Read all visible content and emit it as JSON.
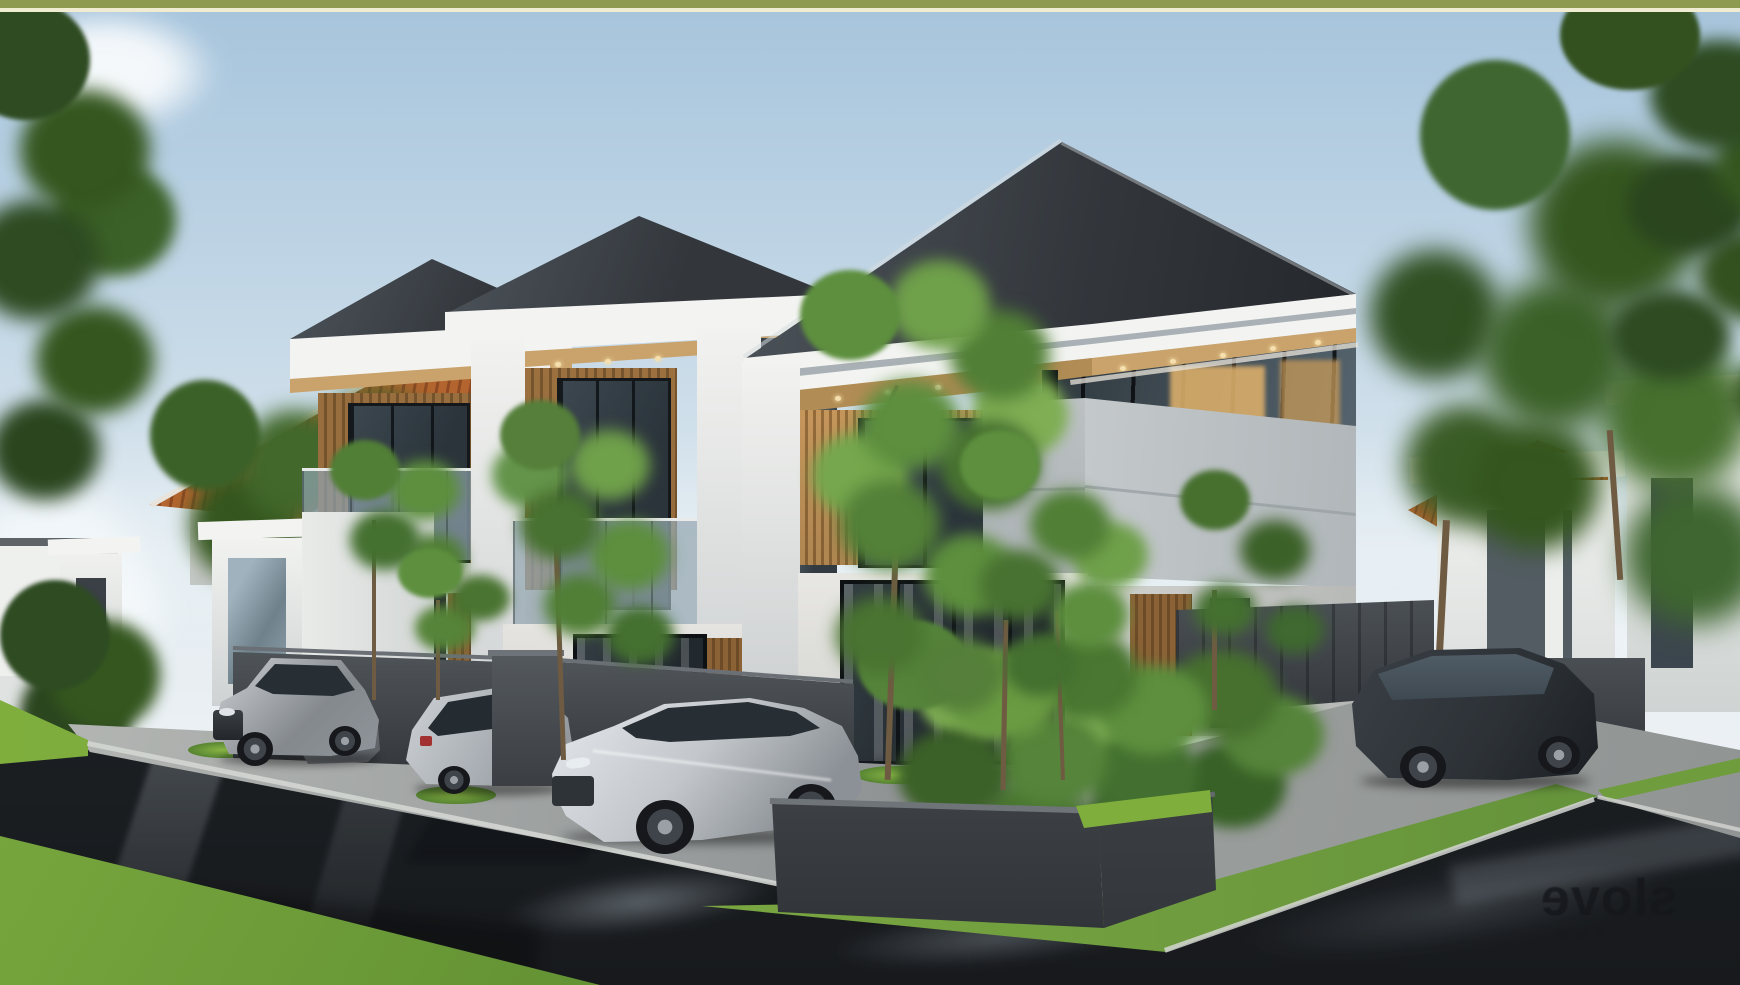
{
  "meta": {
    "kind": "architectural-exterior-render",
    "width_px": 1740,
    "height_px": 985,
    "alt": "3D exterior rendering of a row of modern two-storey minimalist townhouses on a wet street corner, dark hip roofs with white fascias, wood-slat upper walls, concrete balcony parapets, silver cars parked in the driveways, a dark SUV at the right, tropical planter beds, and a mirrored studio watermark on the road"
  },
  "watermark": {
    "text_mirrored": "slove",
    "note": "rendered horizontally mirrored so it reads like the stamped logo in the photo",
    "subtext": "w w w",
    "color": "#15171b"
  },
  "scene": {
    "townhouses_visible": 3,
    "background_buildings": [
      "terracotta tiled-roof house on the left",
      "single-storey white house on the right"
    ],
    "parked_cars": [
      {
        "type": "suv",
        "color": "silver"
      },
      {
        "type": "sedan",
        "color": "gray"
      },
      {
        "type": "hatchback",
        "color": "silver"
      },
      {
        "type": "sedan",
        "color": "silver"
      },
      {
        "type": "suv",
        "color": "dark-gray"
      }
    ],
    "weather": "clear pale-blue sky, road wet with puddle reflections"
  },
  "palette": {
    "frame_olive": "#8e9a4f",
    "frame_cream": "#efecd2",
    "sky_top": "#a6c4dc",
    "sky_mid": "#c6d9e7",
    "sky_low": "#e4ecf1",
    "cloud": "#f7fafc",
    "roof": "#33373c",
    "roof_light": "#4d545b",
    "fascia": "#f3f4f2",
    "fascia_shadow": "#aab1b6",
    "soffit": "#c9a36b",
    "soffit_dark": "#b28c55",
    "wood": "#a97a46",
    "wood_dark": "#7e5a31",
    "wood_lit": "#cf9f63",
    "glass": "#2b343b",
    "glass_frame": "#14181b",
    "warm_light": "#d9ad6a",
    "concrete": "#d6dadb",
    "wall": "#e9e8e4",
    "fence_dark": "#35393d",
    "plant": "#55843a",
    "plant_dark": "#3c6128",
    "grass": "#7fae3d",
    "grass_dark": "#57862f",
    "road": "#23272b",
    "pave_dark": "#8f9394",
    "curb": "#d3d6d2",
    "car_silver": "#c3c7cb",
    "car_silver_dark": "#84898e",
    "car_glass": "#272e34",
    "wheel": "#16181b",
    "suv_dark": "#2c3136",
    "taillight": "#a23232",
    "terracotta": "#b4652f",
    "terracotta_dark": "#8d4a23",
    "trunk": "#6e5b42",
    "glow": "#f6dfae",
    "watermark": "#15171b"
  }
}
